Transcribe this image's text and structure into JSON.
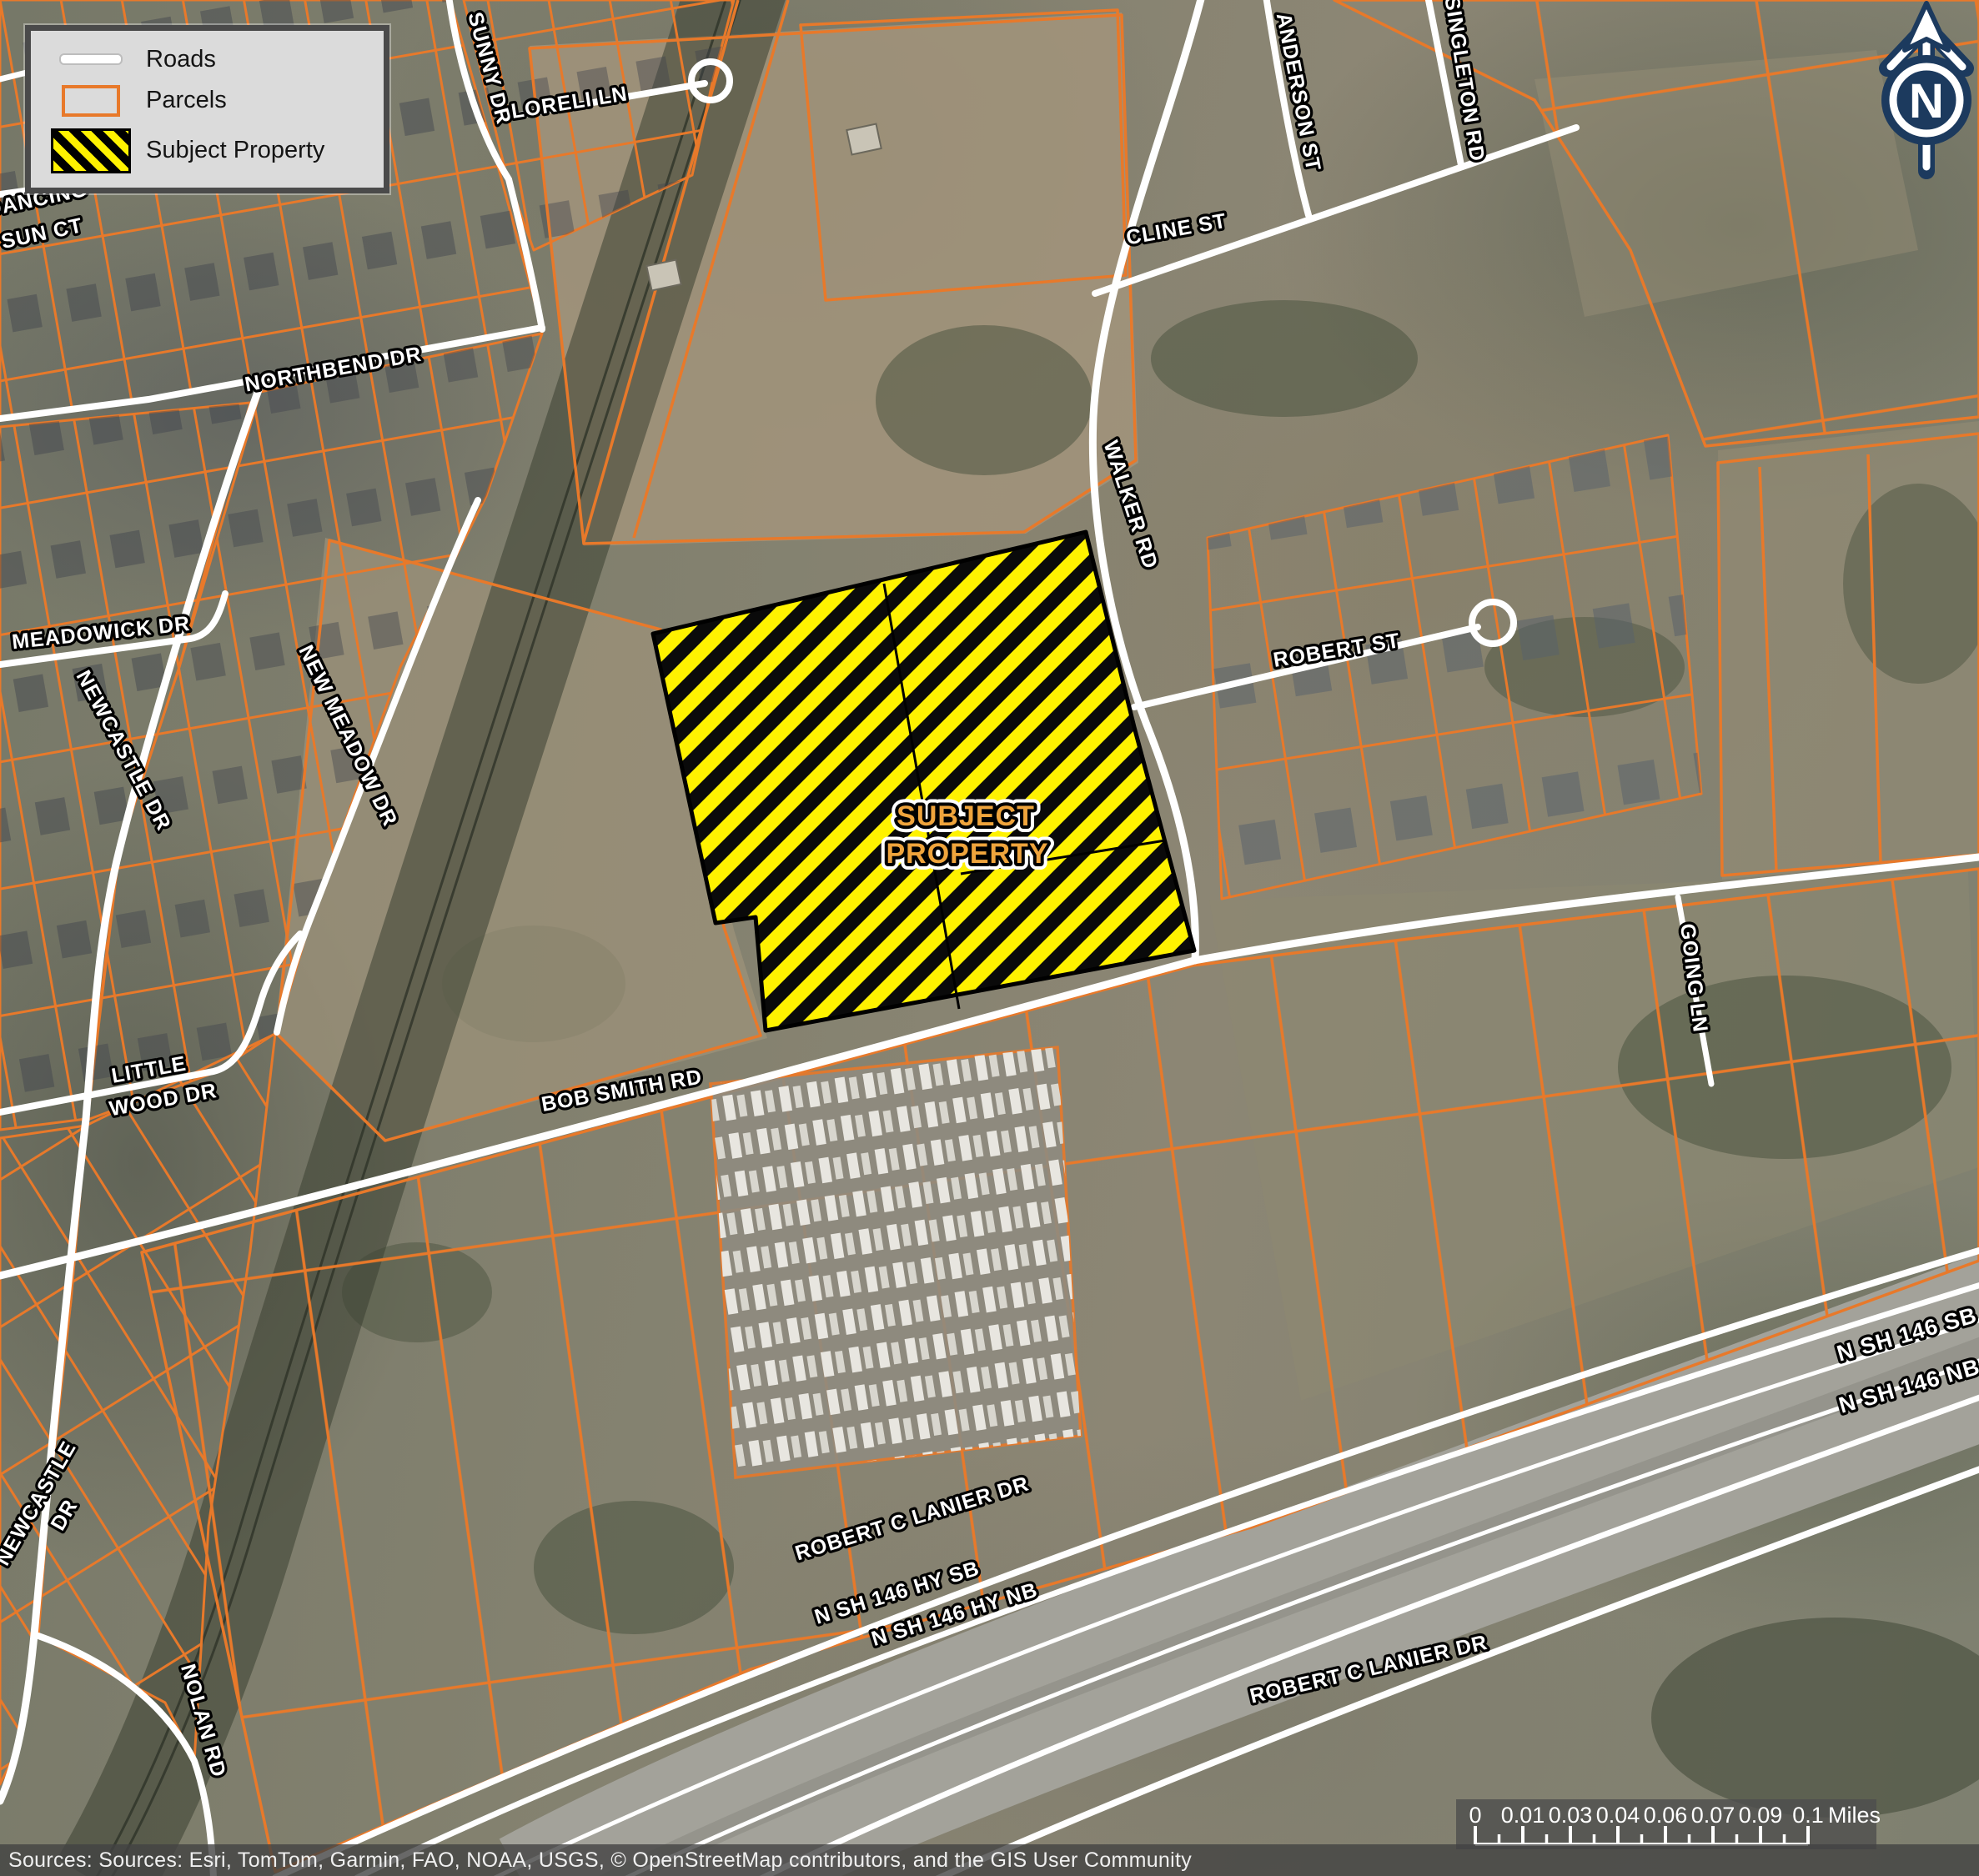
{
  "legend": {
    "items": [
      {
        "label": "Roads"
      },
      {
        "label": "Parcels"
      },
      {
        "label": "Subject Property"
      }
    ]
  },
  "north_arrow": {
    "letter": "N"
  },
  "scale_bar": {
    "labels": [
      "0",
      "0.01",
      "0.03",
      "0.04",
      "0.06",
      "0.07",
      "0.09",
      "0.1"
    ],
    "unit": "Miles"
  },
  "attribution": {
    "text": "Sources: Sources: Esri, TomTom, Garmin, FAO, NOAA, USGS, © OpenStreetMap contributors, and the GIS User Community"
  },
  "subject_property": {
    "line1": "SUBJECT",
    "line2": "PROPERTY"
  },
  "colors": {
    "parcel_orange": "#E8792A",
    "subject_yellow": "#FFF200",
    "subject_label_orange": "#EFA43C",
    "north_arrow_navy": "#1C3A5E"
  },
  "map": {
    "road_labels": [
      {
        "id": "dancing",
        "text": "DANCING"
      },
      {
        "id": "sun-ct",
        "text": "SUN CT"
      },
      {
        "id": "sunny-dr",
        "text": "SUNNY DR"
      },
      {
        "id": "loreli-ln",
        "text": "LORELI LN"
      },
      {
        "id": "northbend-dr",
        "text": "NORTHBEND DR"
      },
      {
        "id": "cline-st",
        "text": "CLINE ST"
      },
      {
        "id": "anderson-st",
        "text": "ANDERSON ST"
      },
      {
        "id": "singleton-rd",
        "text": "SINGLETON RD"
      },
      {
        "id": "walker-rd",
        "text": "WALKER RD"
      },
      {
        "id": "robert-st",
        "text": "ROBERT ST"
      },
      {
        "id": "meadowick-dr",
        "text": "MEADOWICK DR"
      },
      {
        "id": "newcastle-dr-upper",
        "text": "NEWCASTLE DR"
      },
      {
        "id": "new-meadow-dr",
        "text": "NEW MEADOW DR"
      },
      {
        "id": "little",
        "text": "LITTLE"
      },
      {
        "id": "wood-dr",
        "text": "WOOD DR"
      },
      {
        "id": "newcastle-lower",
        "text": "NEWCASTLE"
      },
      {
        "id": "newcastle-lower-dr",
        "text": "DR"
      },
      {
        "id": "nolan-rd",
        "text": "NOLAN RD"
      },
      {
        "id": "bob-smith-rd",
        "text": "BOB SMITH RD"
      },
      {
        "id": "going-ln",
        "text": "GOING LN"
      },
      {
        "id": "robert-c-lanier-dr-1",
        "text": "ROBERT C LANIER DR"
      },
      {
        "id": "n-sh-146-hy-sb",
        "text": "N SH 146 HY SB"
      },
      {
        "id": "n-sh-146-hy-nb",
        "text": "N SH 146 HY NB"
      },
      {
        "id": "n-sh-146-sb",
        "text": "N SH 146 SB"
      },
      {
        "id": "n-sh-146-nb",
        "text": "N SH 146 NB"
      },
      {
        "id": "robert-c-lanier-dr-2",
        "text": "ROBERT C LANIER DR"
      }
    ]
  }
}
